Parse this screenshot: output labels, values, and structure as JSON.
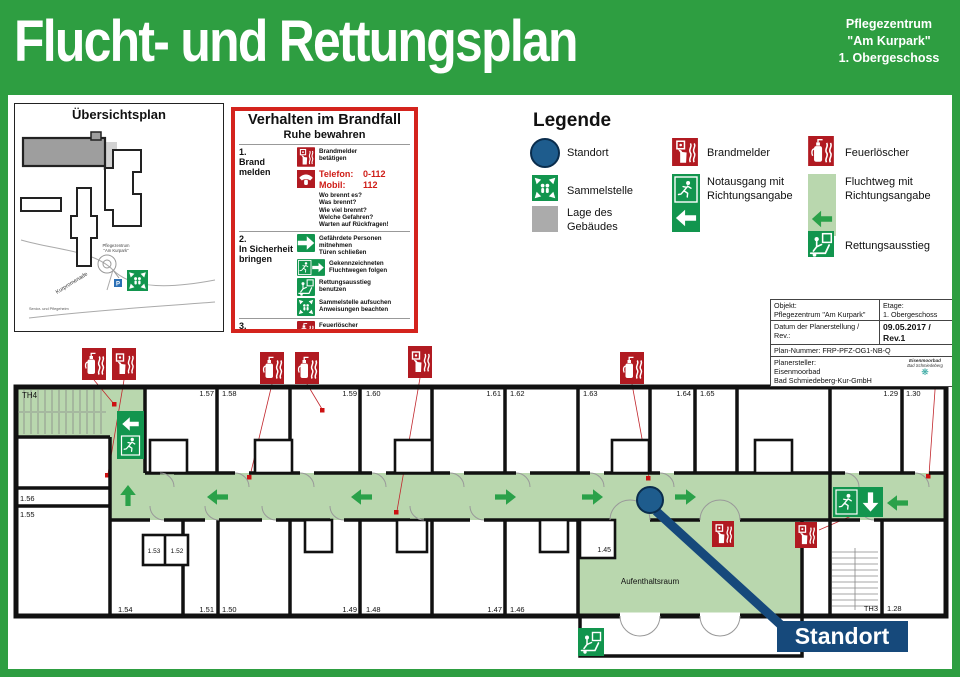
{
  "colors": {
    "brand_green": "#2e9e41",
    "safety_green": "#12954e",
    "route_light_green": "#b9d7ae",
    "arrow_green": "#2aa149",
    "signal_red": "#b11a21",
    "border_red": "#d4231d",
    "standort_blue": "#1e5c8d",
    "callout_navy": "#16497b",
    "building_gray": "#ababab"
  },
  "header": {
    "title": "Flucht- und Rettungsplan",
    "org_line1": "Pflegezentrum",
    "org_line2": "\"Am Kurpark\"",
    "org_line3": "1. Obergeschoss"
  },
  "overview": {
    "title": "Übersichtsplan",
    "street": "Kurpromenade",
    "building_line1": "Pflegezentrum",
    "building_line2": "\"Am Kurpark\"",
    "facility": "Senior- und Pflegeheim",
    "parking": "P"
  },
  "brandfall": {
    "title": "Verhalten im Brandfall",
    "subtitle": "Ruhe bewahren",
    "step1_num": "1.",
    "step1_label": "Brand melden",
    "item_brandmelder": "Brandmelder\nbetätigen",
    "tel_label": "Telefon:",
    "tel_value": "0-112",
    "mobil_label": "Mobil:",
    "mobil_value": "112",
    "questions": "Wo brennt es?\nWas brennt?\nWie viel brennt?\nWelche Gefahren?\nWarten auf Rückfragen!",
    "step2_num": "2.",
    "step2_label": "In Sicherheit\nbringen",
    "item_persons": "Gefährdete Personen\nmitnehmen\nTüren schließen",
    "item_route": "Gekennzeichneten\nFluchtwegen folgen",
    "item_exit": "Rettungsausstieg\nbenutzen",
    "item_assembly": "Sammelstelle aufsuchen\nAnweisungen beachten",
    "step3_num": "3.",
    "step3_label": "Löschversuch\nunternehmen",
    "item_extinguisher": "Feuerlöscher\nbenutzen"
  },
  "legend": {
    "title": "Legende",
    "items": [
      {
        "icon": "standort-icon",
        "label": "Standort"
      },
      {
        "icon": "sammelstelle-icon",
        "label": "Sammelstelle"
      },
      {
        "icon": "building-location-icon",
        "label": "Lage des\nGebäudes"
      },
      {
        "icon": "brandmelder-icon",
        "label": "Brandmelder"
      },
      {
        "icon": "notausgang-icon",
        "label": "Notausgang mit\nRichtungsangabe"
      },
      {
        "icon": "feuerloescher-icon",
        "label": "Feuerlöscher"
      },
      {
        "icon": "fluchtweg-icon",
        "label": "Fluchtweg mit\nRichtungsangabe"
      },
      {
        "icon": "rettungsausstieg-icon",
        "label": "Rettungsausstieg"
      }
    ]
  },
  "infobox": {
    "objekt_label": "Objekt:",
    "objekt_value": "Pflegezentrum \"Am Kurpark\"",
    "etage_label": "Etage:",
    "etage_value": "1. Obergeschoss",
    "datum_label": "Datum der Planerstellung / Rev.:",
    "datum_value": "09.05.2017 / Rev.1",
    "plannummer": "Plan-Nummer: FRP-PFZ-OG1-NB-Q",
    "planersteller_label": "Planersteller:",
    "planersteller_line1": "Eisenmoorbad",
    "planersteller_line2": "Bad Schmiedeberg-Kur-GmbH",
    "logo_line1": "Eisenmoorbad",
    "logo_line2": "Bad Schmiedeberg",
    "logo_glyph": "❋"
  },
  "floorplan": {
    "labels": [
      "TH4",
      "1.57",
      "1.58",
      "1.59",
      "1.60",
      "1.61",
      "1.62",
      "1.63",
      "1.64",
      "1.65",
      "1.29",
      "1.30",
      "1.56",
      "1.55",
      "1.53",
      "1.52",
      "1.54",
      "1.51",
      "1.50",
      "1.49",
      "1.48",
      "1.47",
      "1.46",
      "1.45",
      "TH3",
      "1.28"
    ],
    "aufenthaltsraum": "Aufenthaltsraum",
    "standort": "Standort"
  }
}
